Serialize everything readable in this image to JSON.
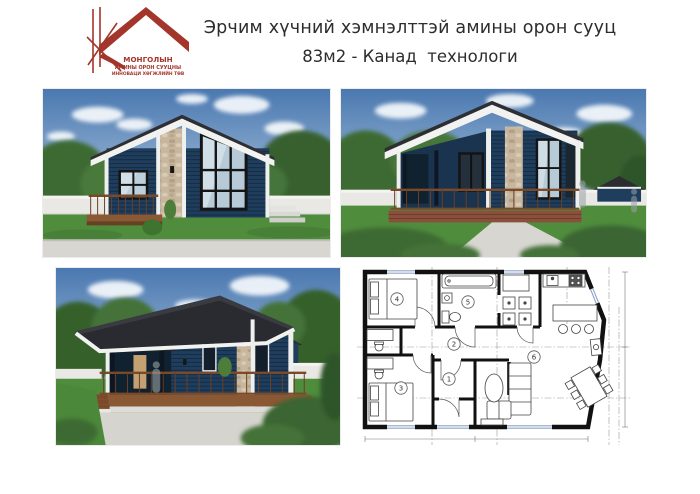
{
  "header": {
    "title_line1": "Эрчим хүчний хэмнэлттэй амины орон сууц",
    "title_line2": "83м2 - Канад  технологи"
  },
  "logo": {
    "line1": "МОНГОЛЫН",
    "line2": "АМИНЫ ОРОН СУУЦНЫ",
    "line3": "ИННОВАЦИ ХӨГЖЛИЙН ТӨВ"
  },
  "floor_plan": {
    "room_numbers": [
      "1",
      "2",
      "3",
      "4",
      "5",
      "6"
    ]
  },
  "colors": {
    "brand_red": "#a4352b",
    "house_navy": "#1f3d5c",
    "roof_dark": "#2a2b30",
    "grass_green": "#4f8d3d",
    "sky_blue": "#4a78b0"
  }
}
